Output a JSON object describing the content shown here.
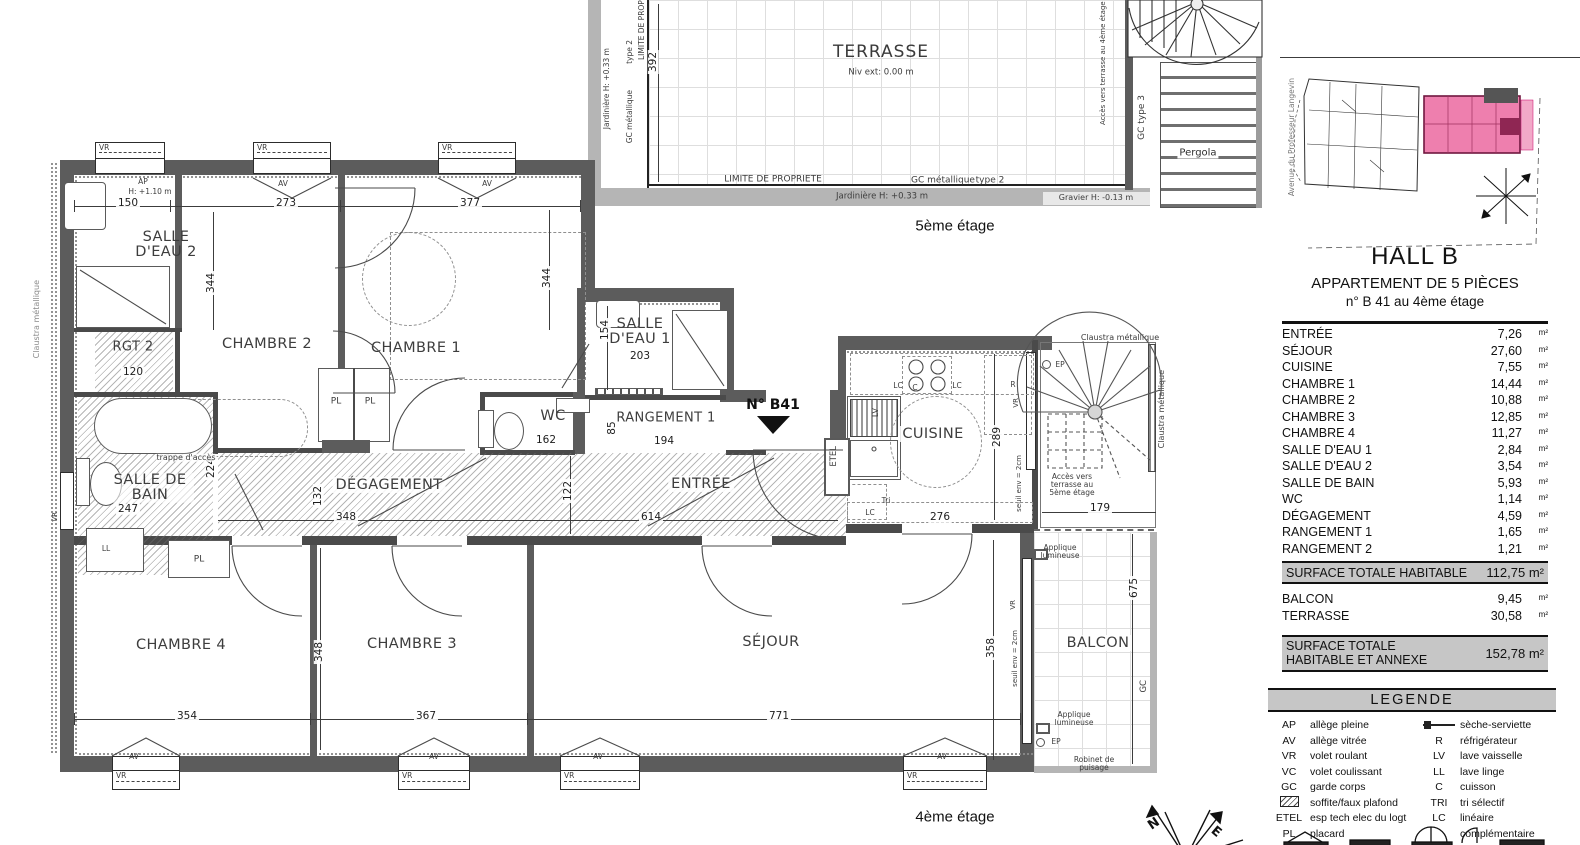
{
  "labels": {
    "vr": "VR",
    "av": "AV",
    "ap": "AP",
    "pl": "PL",
    "ll": "LL",
    "lv": "LV",
    "lc": "LC",
    "c": "C",
    "r": "R",
    "tri": "Tri",
    "etel": "ETEL",
    "ep": "EP",
    "gc": "GC",
    "h110": "H: +1.10 m",
    "n": "N",
    "e": "E"
  },
  "floor5": {
    "caption": "5ème étage",
    "room": "TERRASSE",
    "niv": "Niv ext: 0.00 m",
    "dim392": "392",
    "limite": "LIMITE DE PROPRIETE",
    "gcmet": "GC métallique",
    "type2": "type 2",
    "jardiniere": "Jardinière H: +0.33 m",
    "gravier": "Gravier H: -0.13 m",
    "pergola": "Pergola",
    "gctype3": "GC   type 3",
    "acces": "Accès vers terrasse au 4ème étage",
    "parois": "Parois en bois"
  },
  "sitemap": {
    "street": "Avenue du Professeur Langevin"
  },
  "floor4": {
    "caption": "4ème étage",
    "unit_no": "N° B41",
    "claustra": "Claustra métallique",
    "acces": "Accès vers terrasse au 5ème étage",
    "seuil": "seuil env = 2cm",
    "applique": "Applique lumineuse",
    "robinet": "Robinet de puisage",
    "trappe": "trappe d'accès",
    "rooms": {
      "sde2": "SALLE D'EAU 2",
      "rgt2": "RGT 2",
      "ch2": "CHAMBRE 2",
      "ch1": "CHAMBRE 1",
      "sde1": "SALLE D'EAU 1",
      "wc": "WC",
      "rgt1": "RANGEMENT 1",
      "entree": "ENTRÉE",
      "cuisine": "CUISINE",
      "sdb": "SALLE DE BAIN",
      "deg": "DÉGAGEMENT",
      "ch4": "CHAMBRE 4",
      "ch3": "CHAMBRE 3",
      "sejour": "SÉJOUR",
      "balcon": "BALCON"
    },
    "dims": {
      "d150": "150",
      "d273": "273",
      "d377": "377",
      "d344": "344",
      "d120": "120",
      "d154": "154",
      "d203": "203",
      "d162": "162",
      "d194": "194",
      "d85": "85",
      "d122": "122",
      "d614": "614",
      "d348": "348",
      "d132": "132",
      "d247": "247",
      "d224": "224",
      "d276": "276",
      "d289": "289",
      "d179": "179",
      "d354": "354",
      "d367": "367",
      "d771": "771",
      "d358": "358",
      "d675": "675"
    }
  },
  "panel": {
    "hall": "HALL B",
    "subtitle": "APPARTEMENT DE 5 PIÈCES",
    "unit_line": "n° B 41 au 4ème étage",
    "unit": "m²",
    "rows": [
      {
        "name": "ENTRÉE",
        "value": "7,26"
      },
      {
        "name": "SÉJOUR",
        "value": "27,60"
      },
      {
        "name": "CUISINE",
        "value": "7,55"
      },
      {
        "name": "CHAMBRE 1",
        "value": "14,44"
      },
      {
        "name": "CHAMBRE 2",
        "value": "10,88"
      },
      {
        "name": "CHAMBRE 3",
        "value": "12,85"
      },
      {
        "name": "CHAMBRE 4",
        "value": "11,27"
      },
      {
        "name": "SALLE D'EAU 1",
        "value": "2,84"
      },
      {
        "name": "SALLE D'EAU 2",
        "value": "3,54"
      },
      {
        "name": "SALLE DE BAIN",
        "value": "5,93"
      },
      {
        "name": "WC",
        "value": "1,14"
      },
      {
        "name": "DÉGAGEMENT",
        "value": "4,59"
      },
      {
        "name": "RANGEMENT 1",
        "value": "1,65"
      },
      {
        "name": "RANGEMENT 2",
        "value": "1,21"
      }
    ],
    "total1_label": "SURFACE TOTALE HABITABLE",
    "total1_value": "112,75 m²",
    "annex_rows": [
      {
        "name": "BALCON",
        "value": "9,45"
      },
      {
        "name": "TERRASSE",
        "value": "30,58"
      }
    ],
    "total2_label": "SURFACE TOTALE HABITABLE ET ANNEXE",
    "total2_value": "152,78 m²"
  },
  "legend": {
    "title": "LEGENDE",
    "left": [
      {
        "code": "AP",
        "label": "allège pleine"
      },
      {
        "code": "AV",
        "label": "allège vitrée"
      },
      {
        "code": "VR",
        "label": "volet roulant"
      },
      {
        "code": "VC",
        "label": "volet coulissant"
      },
      {
        "code": "GC",
        "label": "garde corps"
      },
      {
        "code": "",
        "label": "soffite/faux plafond"
      },
      {
        "code": "ETEL",
        "label": "esp tech elec du logt"
      },
      {
        "code": "PL",
        "label": "placard"
      }
    ],
    "right": [
      {
        "code": "",
        "label": "sèche-serviette"
      },
      {
        "code": "R",
        "label": "réfrigérateur"
      },
      {
        "code": "LV",
        "label": "lave vaisselle"
      },
      {
        "code": "LL",
        "label": "lave linge"
      },
      {
        "code": "C",
        "label": "cuisson"
      },
      {
        "code": "TRI",
        "label": "tri sélectif"
      },
      {
        "code": "LC",
        "label": "linéaire complémentaire"
      }
    ]
  }
}
